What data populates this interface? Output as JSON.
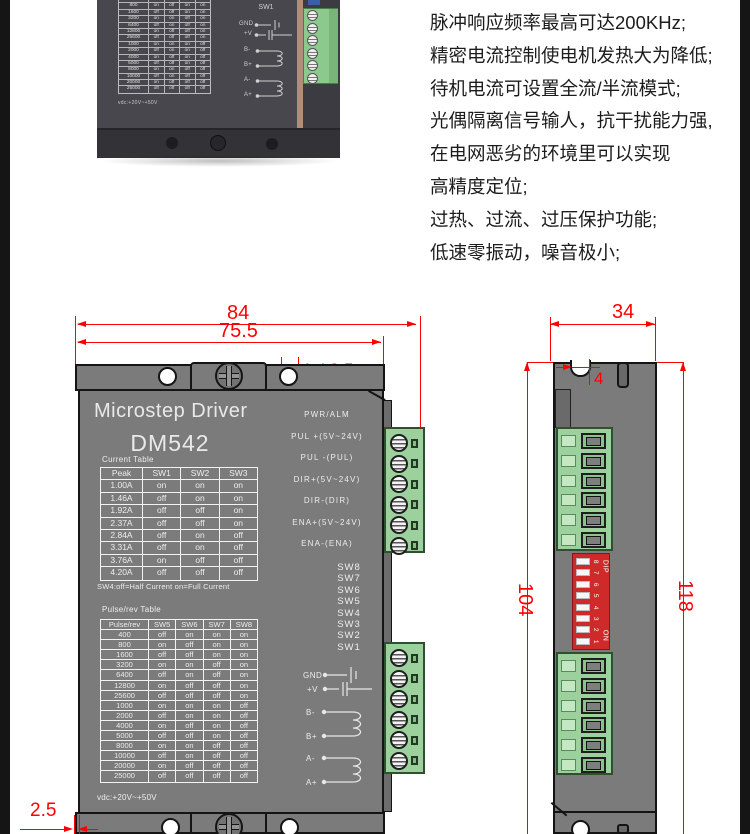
{
  "features": {
    "lines": [
      "脉冲响应频率最高可达200KHz;",
      "精密电流控制使电机发热大为降低;",
      "待机电流可设置全流/半流模式;",
      "光偶隔离信号输人，抗干扰能力强,",
      "在电网恶劣的环境里可以实现",
      "高精度定位;",
      "过热、过流、过压保护功能;",
      "低速零振动，噪音极小;"
    ]
  },
  "photo": {
    "sw_labels": [
      "SW2",
      "SW1"
    ],
    "pins": {
      "gnd": "GND",
      "v": "+V",
      "b_minus": "B-",
      "b_plus": "B+",
      "a_minus": "A-",
      "a_plus": "A+"
    },
    "table_rows": [
      [
        "400",
        "off",
        "on",
        "on",
        "on"
      ],
      [
        "800",
        "on",
        "off",
        "on",
        "on"
      ],
      [
        "1600",
        "off",
        "off",
        "on",
        "on"
      ],
      [
        "3200",
        "on",
        "on",
        "off",
        "on"
      ],
      [
        "6400",
        "off",
        "on",
        "off",
        "on"
      ],
      [
        "12800",
        "on",
        "off",
        "off",
        "on"
      ],
      [
        "25600",
        "off",
        "off",
        "off",
        "on"
      ],
      [
        "1000",
        "on",
        "on",
        "on",
        "off"
      ],
      [
        "2000",
        "off",
        "on",
        "on",
        "off"
      ],
      [
        "4000",
        "on",
        "off",
        "on",
        "off"
      ],
      [
        "5000",
        "off",
        "off",
        "on",
        "off"
      ],
      [
        "8000",
        "on",
        "on",
        "off",
        "off"
      ],
      [
        "10000",
        "off",
        "on",
        "off",
        "off"
      ],
      [
        "20000",
        "on",
        "off",
        "off",
        "off"
      ],
      [
        "25000",
        "off",
        "off",
        "off",
        "off"
      ]
    ],
    "note": "vdc:+20V~+50V"
  },
  "front_view": {
    "title": "Microstep Driver",
    "model": "DM542",
    "dims": {
      "overall_width": "84",
      "mount_width": "75.5",
      "holes": "4-Φ3.5",
      "flange_offset": "2.5"
    },
    "current_table": {
      "label": "Current Table",
      "headers": [
        "Peak",
        "SW1",
        "SW2",
        "SW3"
      ],
      "rows": [
        [
          "1.00A",
          "on",
          "on",
          "on"
        ],
        [
          "1.46A",
          "off",
          "on",
          "on"
        ],
        [
          "1.92A",
          "off",
          "off",
          "on"
        ],
        [
          "2.37A",
          "off",
          "off",
          "on"
        ],
        [
          "2.84A",
          "off",
          "on",
          "off"
        ],
        [
          "3.31A",
          "off",
          "on",
          "off"
        ],
        [
          "3.76A",
          "on",
          "off",
          "off"
        ],
        [
          "4.20A",
          "off",
          "off",
          "off"
        ]
      ],
      "note": "SW4:off=Half Current on=Full Current"
    },
    "pulse_table": {
      "label": "Pulse/rev Table",
      "headers": [
        "Pulse/rev",
        "SW5",
        "SW6",
        "SW7",
        "SW8"
      ],
      "rows": [
        [
          "400",
          "off",
          "on",
          "on",
          "on"
        ],
        [
          "800",
          "on",
          "off",
          "on",
          "on"
        ],
        [
          "1600",
          "off",
          "off",
          "on",
          "on"
        ],
        [
          "3200",
          "on",
          "on",
          "off",
          "on"
        ],
        [
          "6400",
          "off",
          "on",
          "off",
          "on"
        ],
        [
          "12800",
          "on",
          "off",
          "off",
          "on"
        ],
        [
          "25600",
          "off",
          "off",
          "off",
          "on"
        ],
        [
          "1000",
          "on",
          "on",
          "on",
          "off"
        ],
        [
          "2000",
          "off",
          "on",
          "on",
          "off"
        ],
        [
          "4000",
          "on",
          "off",
          "on",
          "off"
        ],
        [
          "5000",
          "off",
          "off",
          "on",
          "off"
        ],
        [
          "8000",
          "on",
          "on",
          "off",
          "off"
        ],
        [
          "10000",
          "off",
          "on",
          "off",
          "off"
        ],
        [
          "20000",
          "on",
          "off",
          "off",
          "off"
        ],
        [
          "25000",
          "off",
          "off",
          "off",
          "off"
        ]
      ],
      "note": "vdc:+20V~+50V"
    },
    "terminal_labels": [
      "PWR/ALM",
      "PUL +(5V~24V)",
      "PUL -(PUL)",
      "DIR+(5V~24V)",
      "DIR-(DIR)",
      "ENA+(5V~24V)",
      "ENA-(ENA)"
    ],
    "sw_labels": [
      "SW8",
      "SW7",
      "SW6",
      "SW5",
      "SW4",
      "SW3",
      "SW2",
      "SW1"
    ],
    "pins": {
      "gnd": "GND",
      "v": "+V",
      "b_minus": "B-",
      "b_plus": "B+",
      "a_minus": "A-",
      "a_plus": "A+"
    }
  },
  "side_view": {
    "dims": {
      "width": "34",
      "notch": "4",
      "body_height": "104",
      "overall_height": "118"
    },
    "dip": {
      "label_top": "DIP",
      "label_on": "ON",
      "numbers_top_to_bottom": [
        "8",
        "7",
        "6",
        "5",
        "4",
        "3",
        "2",
        "1"
      ]
    }
  },
  "colors": {
    "dim_red": "#ff0000",
    "panel_gray": "#7b7b7b",
    "terminal_green": "#9cd09c",
    "dip_red": "#cf2a2a"
  }
}
